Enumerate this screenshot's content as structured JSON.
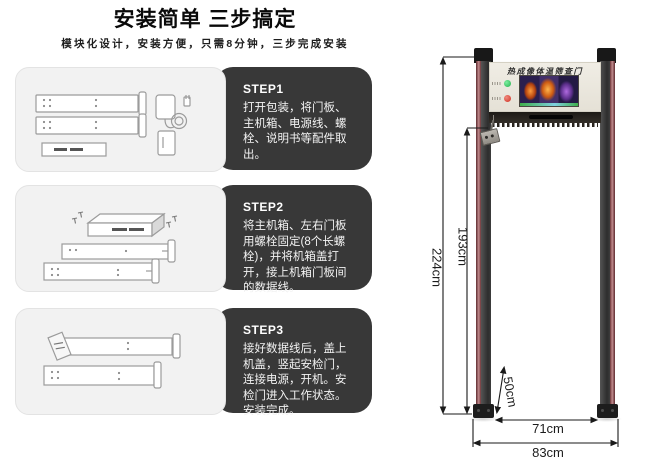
{
  "header": {
    "title": "安装简单 三步搞定",
    "subtitle": "模块化设计，安装方便，只需8分钟，三步完成安装"
  },
  "steps": [
    {
      "label": "STEP1",
      "body": "打开包装，将门板、主机箱、电源线、螺栓、说明书等配件取出。"
    },
    {
      "label": "STEP2",
      "body": "将主机箱、左右门板用螺栓固定(8个长螺栓)，并将机箱盖打开，接上机箱门板间的数据线。"
    },
    {
      "label": "STEP3",
      "body": "接好数据线后，盖上机盖，竖起安检门，连接电源，开机。安检门进入工作状态。安装完成。"
    }
  ],
  "door": {
    "panel_title": "热成像体温筛查门",
    "dimensions": {
      "total_height": "224cm",
      "inner_height": "193cm",
      "base_depth": "50cm",
      "inner_width": "71cm",
      "outer_width": "83cm"
    },
    "colors": {
      "pillar_red": "#7c3a3d",
      "pillar_dark": "#3a3a3a",
      "header_panel_bg": "#ece8df",
      "green_light": "#22b14c",
      "red_light": "#cf2f22"
    }
  },
  "colors": {
    "step_panel_bg": "#383838",
    "card_bg": "#f2f2f2",
    "background": "#ffffff"
  }
}
